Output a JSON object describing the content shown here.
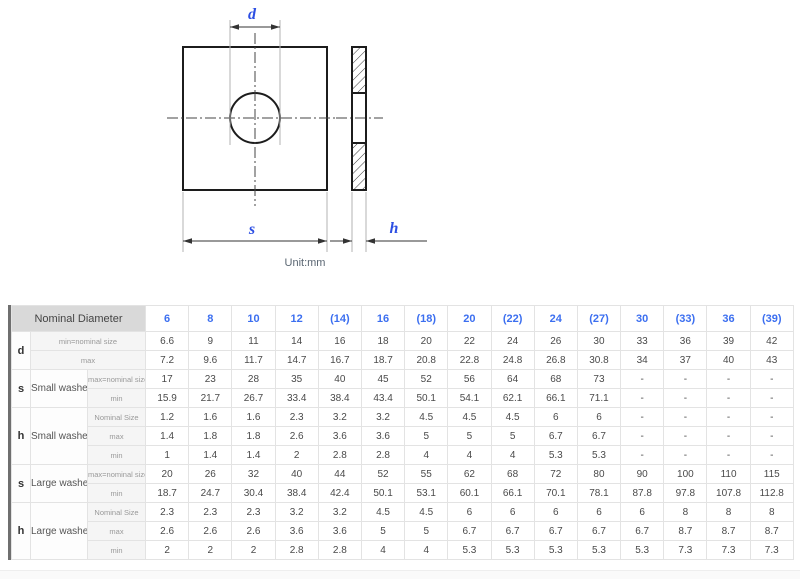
{
  "drawing": {
    "d_label": "d",
    "s_label": "s",
    "h_label": "h",
    "unit_note": "Unit:mm",
    "label_color": "#2d4fe3",
    "line_color": "#1c1c1c"
  },
  "table": {
    "accent_color": "#3c6ff0",
    "corner_label": "Nominal Diameter",
    "headers": [
      "6",
      "8",
      "10",
      "12",
      "(14)",
      "16",
      "(18)",
      "20",
      "(22)",
      "24",
      "(27)",
      "30",
      "(33)",
      "36",
      "(39)"
    ],
    "groups": [
      {
        "dim": "d",
        "type": null,
        "rows": [
          {
            "sub": "min=nominal size",
            "values": [
              "6.6",
              "9",
              "11",
              "14",
              "16",
              "18",
              "20",
              "22",
              "24",
              "26",
              "30",
              "33",
              "36",
              "39",
              "42"
            ]
          },
          {
            "sub": "max",
            "values": [
              "7.2",
              "9.6",
              "11.7",
              "14.7",
              "16.7",
              "18.7",
              "20.8",
              "22.8",
              "24.8",
              "26.8",
              "30.8",
              "34",
              "37",
              "40",
              "43"
            ]
          }
        ]
      },
      {
        "dim": "s",
        "type": "Small washer",
        "rows": [
          {
            "sub": "max=nominal size",
            "values": [
              "17",
              "23",
              "28",
              "35",
              "40",
              "45",
              "52",
              "56",
              "64",
              "68",
              "73",
              "-",
              "-",
              "-",
              "-"
            ]
          },
          {
            "sub": "min",
            "values": [
              "15.9",
              "21.7",
              "26.7",
              "33.4",
              "38.4",
              "43.4",
              "50.1",
              "54.1",
              "62.1",
              "66.1",
              "71.1",
              "-",
              "-",
              "-",
              "-"
            ]
          }
        ]
      },
      {
        "dim": "h",
        "type": "Small washer",
        "rows": [
          {
            "sub": "Nominal Size",
            "values": [
              "1.2",
              "1.6",
              "1.6",
              "2.3",
              "3.2",
              "3.2",
              "4.5",
              "4.5",
              "4.5",
              "6",
              "6",
              "-",
              "-",
              "-",
              "-"
            ]
          },
          {
            "sub": "max",
            "values": [
              "1.4",
              "1.8",
              "1.8",
              "2.6",
              "3.6",
              "3.6",
              "5",
              "5",
              "5",
              "6.7",
              "6.7",
              "-",
              "-",
              "-",
              "-"
            ]
          },
          {
            "sub": "min",
            "values": [
              "1",
              "1.4",
              "1.4",
              "2",
              "2.8",
              "2.8",
              "4",
              "4",
              "4",
              "5.3",
              "5.3",
              "-",
              "-",
              "-",
              "-"
            ]
          }
        ]
      },
      {
        "dim": "s",
        "type": "Large washer",
        "rows": [
          {
            "sub": "max=nominal size",
            "values": [
              "20",
              "26",
              "32",
              "40",
              "44",
              "52",
              "55",
              "62",
              "68",
              "72",
              "80",
              "90",
              "100",
              "110",
              "115"
            ]
          },
          {
            "sub": "min",
            "values": [
              "18.7",
              "24.7",
              "30.4",
              "38.4",
              "42.4",
              "50.1",
              "53.1",
              "60.1",
              "66.1",
              "70.1",
              "78.1",
              "87.8",
              "97.8",
              "107.8",
              "112.8"
            ]
          }
        ]
      },
      {
        "dim": "h",
        "type": "Large washer",
        "rows": [
          {
            "sub": "Nominal Size",
            "values": [
              "2.3",
              "2.3",
              "2.3",
              "3.2",
              "3.2",
              "4.5",
              "4.5",
              "6",
              "6",
              "6",
              "6",
              "6",
              "8",
              "8",
              "8"
            ]
          },
          {
            "sub": "max",
            "values": [
              "2.6",
              "2.6",
              "2.6",
              "3.6",
              "3.6",
              "5",
              "5",
              "6.7",
              "6.7",
              "6.7",
              "6.7",
              "6.7",
              "8.7",
              "8.7",
              "8.7"
            ]
          },
          {
            "sub": "min",
            "values": [
              "2",
              "2",
              "2",
              "2.8",
              "2.8",
              "4",
              "4",
              "5.3",
              "5.3",
              "5.3",
              "5.3",
              "5.3",
              "7.3",
              "7.3",
              "7.3"
            ]
          }
        ]
      }
    ]
  }
}
